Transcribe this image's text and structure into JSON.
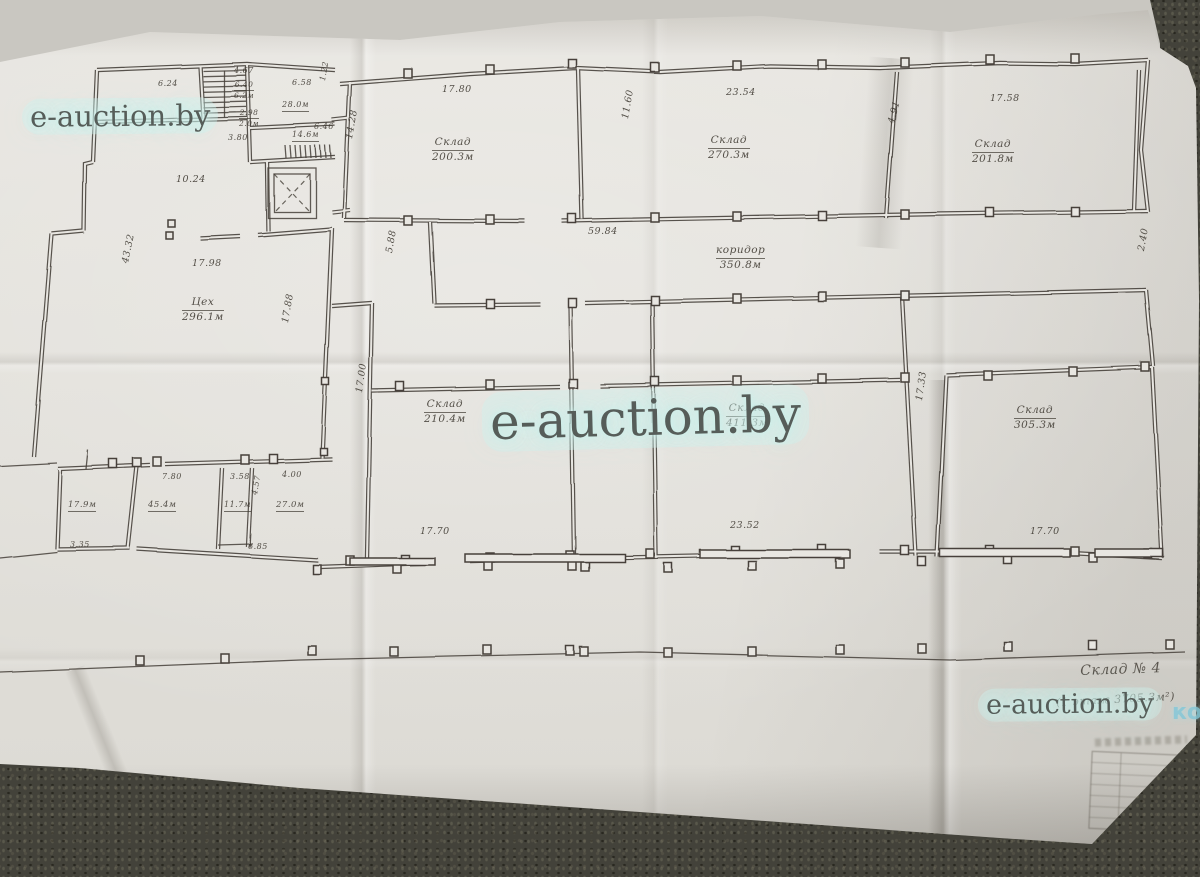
{
  "watermarks": {
    "text": "e-auction.by",
    "partial_right": "ко"
  },
  "colors": {
    "paper": "#e8e6e1",
    "ink": "#46413a",
    "carpet": "#43423a",
    "watermark_text": "#565d59",
    "watermark_glow": "#cdf0ec",
    "ko_blue": "#84c8d8"
  },
  "plan_texts": [
    {
      "name": "label-tsekh",
      "line1": "Цех",
      "line2": "296.1м",
      "x": 182,
      "y": 296,
      "fs": 10.5
    },
    {
      "name": "dim-tsekh-width",
      "text": "17.98",
      "x": 192,
      "y": 258
    },
    {
      "name": "dim-left-height",
      "text": "43.32",
      "x": 120,
      "y": 262,
      "rot": -78
    },
    {
      "name": "dim-tsekh-right",
      "text": "17.88",
      "x": 280,
      "y": 322,
      "rot": -80
    },
    {
      "name": "dim-10-24",
      "text": "10.24",
      "x": 176,
      "y": 174
    },
    {
      "name": "label-sklad-200",
      "line1": "Склад",
      "line2": "200.3м",
      "x": 432,
      "y": 136,
      "fs": 10.5
    },
    {
      "name": "dim-17-80",
      "text": "17.80",
      "x": 442,
      "y": 84
    },
    {
      "name": "dim-11-60",
      "text": "11.60",
      "x": 620,
      "y": 118,
      "rot": -80
    },
    {
      "name": "label-sklad-270",
      "line1": "Склад",
      "line2": "270.3м",
      "x": 708,
      "y": 134,
      "fs": 10.5
    },
    {
      "name": "dim-23-54",
      "text": "23.54",
      "x": 726,
      "y": 87
    },
    {
      "name": "dim-4-91",
      "text": "4.91",
      "x": 886,
      "y": 122,
      "rot": -75
    },
    {
      "name": "label-sklad-201",
      "line1": "Склад",
      "line2": "201.8м",
      "x": 972,
      "y": 138,
      "fs": 10.5
    },
    {
      "name": "dim-17-58",
      "text": "17.58",
      "x": 990,
      "y": 93
    },
    {
      "name": "label-koridor",
      "line1": "коридор",
      "line2": "350.8м",
      "x": 716,
      "y": 244,
      "fs": 10.5
    },
    {
      "name": "dim-59-84",
      "text": "59.84",
      "x": 588,
      "y": 226
    },
    {
      "name": "dim-5-88",
      "text": "5.88",
      "x": 384,
      "y": 252,
      "rot": -80
    },
    {
      "name": "dim-2-40",
      "text": "2.40",
      "x": 1136,
      "y": 250,
      "rot": -80
    },
    {
      "name": "dim-14-28",
      "text": "14.28",
      "x": 344,
      "y": 138,
      "rot": -80
    },
    {
      "name": "label-sklad-210",
      "line1": "Склад",
      "line2": "210.4м",
      "x": 424,
      "y": 398,
      "fs": 10.5
    },
    {
      "name": "dim-17-70-a",
      "text": "17.70",
      "x": 420,
      "y": 526
    },
    {
      "name": "label-sklad-411",
      "line1": "Склад",
      "line2": "411.3м",
      "x": 726,
      "y": 402,
      "fs": 10.5
    },
    {
      "name": "dim-23-52",
      "text": "23.52",
      "x": 730,
      "y": 520
    },
    {
      "name": "dim-17-33",
      "text": "17.33",
      "x": 914,
      "y": 400,
      "rot": -82
    },
    {
      "name": "dim-17-00",
      "text": "17.00",
      "x": 354,
      "y": 392,
      "rot": -82
    },
    {
      "name": "label-sklad-305",
      "line1": "Склад",
      "line2": "305.3м",
      "x": 1014,
      "y": 404,
      "fs": 10.5
    },
    {
      "name": "dim-17-70-b",
      "text": "17.70",
      "x": 1030,
      "y": 526
    },
    {
      "name": "label-room-179",
      "line1": "17.9м",
      "ul": true,
      "x": 68,
      "y": 500,
      "fs": 8.5
    },
    {
      "name": "label-room-454",
      "line1": "45.4м",
      "ul": true,
      "x": 148,
      "y": 500,
      "fs": 8.5
    },
    {
      "name": "label-room-117",
      "line1": "11.7м",
      "ul": true,
      "x": 224,
      "y": 500,
      "fs": 8
    },
    {
      "name": "label-room-270",
      "line1": "27.0м",
      "ul": true,
      "x": 276,
      "y": 500,
      "fs": 8.5
    },
    {
      "name": "dim-7-80",
      "text": "7.80",
      "x": 162,
      "y": 472,
      "fs": 8
    },
    {
      "name": "dim-3-58",
      "text": "3.58",
      "x": 230,
      "y": 472,
      "fs": 8
    },
    {
      "name": "dim-4-00",
      "text": "4.00",
      "x": 282,
      "y": 470,
      "fs": 8
    },
    {
      "name": "dim-4-57",
      "text": "4.57",
      "x": 250,
      "y": 494,
      "rot": -80,
      "fs": 8
    },
    {
      "name": "dim-6-85",
      "text": "6.85",
      "x": 248,
      "y": 542,
      "fs": 8
    },
    {
      "name": "dim-3-35",
      "text": "3.35",
      "x": 70,
      "y": 540,
      "fs": 8
    },
    {
      "name": "label-room-280",
      "line1": "28.0м",
      "ul": true,
      "x": 282,
      "y": 100,
      "fs": 8
    },
    {
      "name": "dim-6-58",
      "text": "6.58",
      "x": 292,
      "y": 78,
      "fs": 8
    },
    {
      "name": "label-room-146",
      "line1": "14.6м",
      "ul": true,
      "x": 292,
      "y": 130,
      "fs": 8
    },
    {
      "name": "dim-6-46",
      "text": "6.46",
      "x": 314,
      "y": 122,
      "fs": 8
    },
    {
      "name": "dim-4-67",
      "text": "4.67",
      "x": 234,
      "y": 66,
      "fs": 8
    },
    {
      "name": "dim-6-24",
      "text": "6.24",
      "x": 158,
      "y": 79,
      "fs": 8
    },
    {
      "name": "label-room-62",
      "line1": "6.40",
      "line2": "6.2м",
      "x": 234,
      "y": 80,
      "fs": 7.5
    },
    {
      "name": "label-room-20",
      "line1": "2.98",
      "line2": "2.0м",
      "x": 239,
      "y": 108,
      "fs": 7.5
    },
    {
      "name": "dim-3-80",
      "text": "3.80",
      "x": 228,
      "y": 133,
      "fs": 8
    },
    {
      "name": "dim-1-22",
      "text": "1.22",
      "x": 318,
      "y": 80,
      "rot": -80,
      "fs": 8
    },
    {
      "name": "note-sklad-4",
      "text": "Склад № 4",
      "x": 1080,
      "y": 663,
      "fs": 14,
      "rot": -2,
      "hand": true
    },
    {
      "name": "note-floor-area",
      "text": "(1 этаж 3705.3м²)",
      "x": 1056,
      "y": 696,
      "fs": 11,
      "rot": -3,
      "hand": true
    }
  ]
}
